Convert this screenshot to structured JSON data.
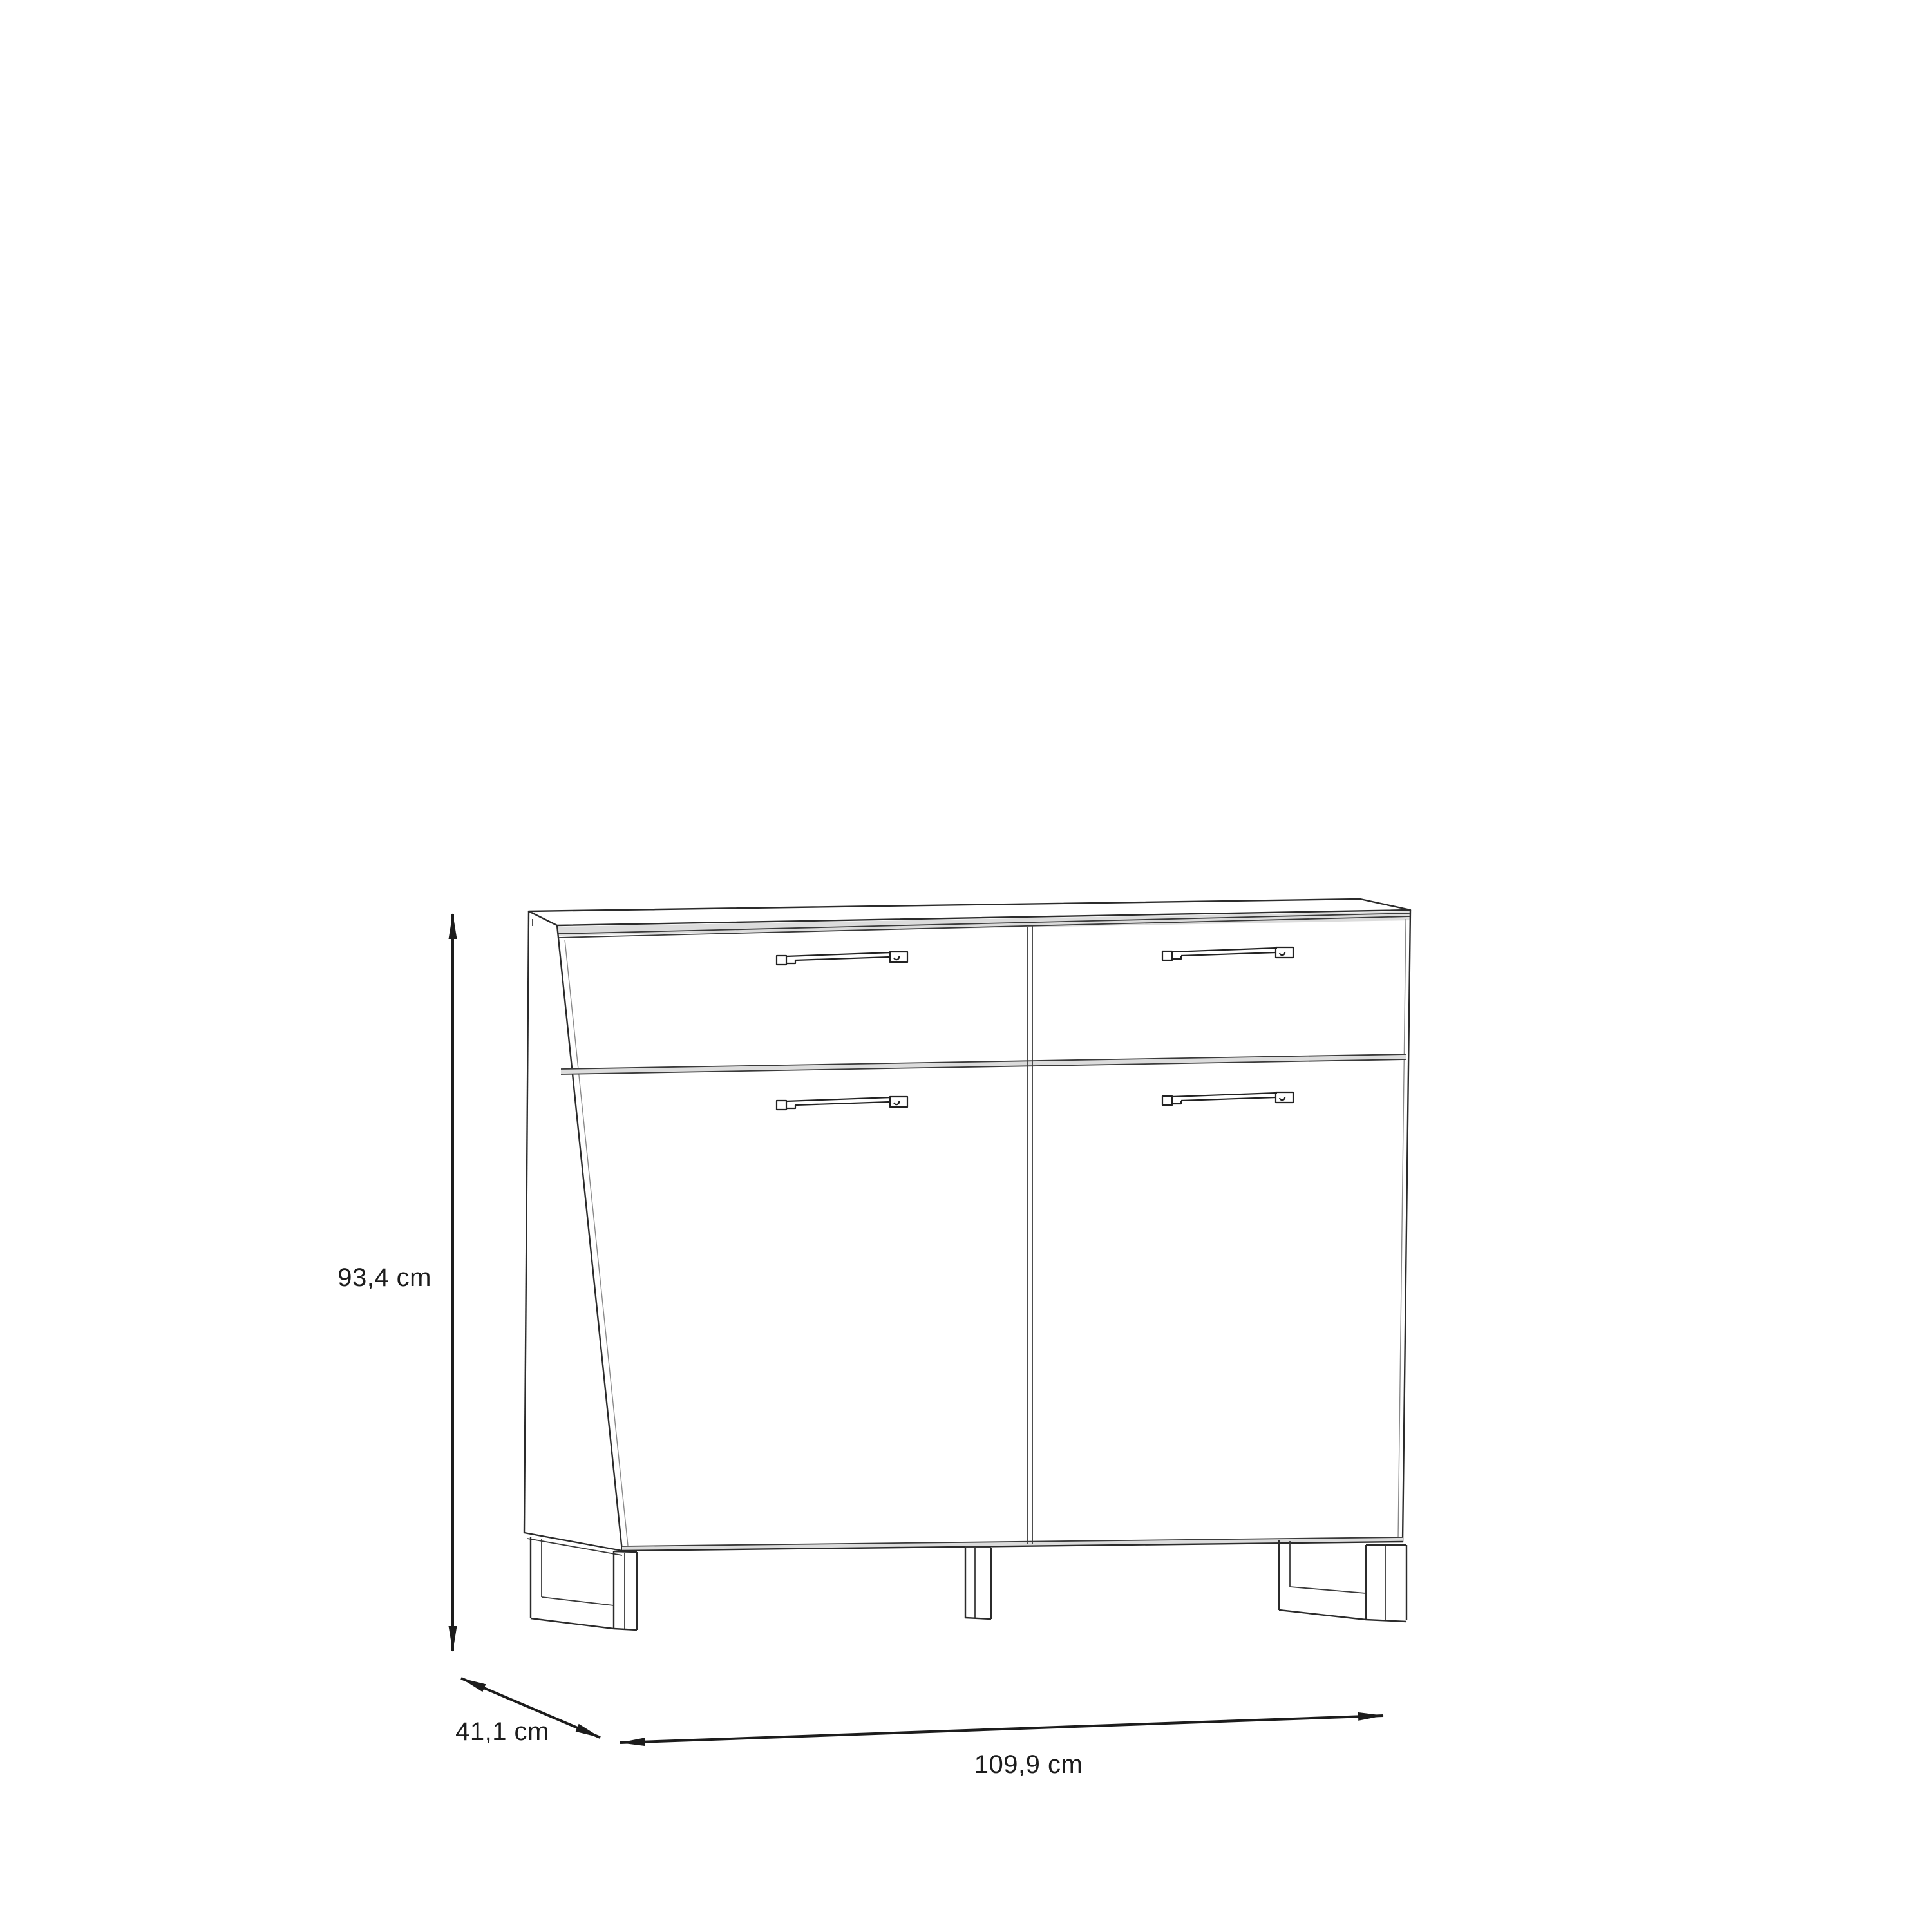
{
  "page": {
    "background": "#ffffff"
  },
  "diagram": {
    "kind": "furniture-dimension-drawing",
    "subject": "sideboard with 2 drawers, 2 doors, bar handles and sled legs",
    "dimensions": {
      "height": {
        "label": "93,4 cm",
        "orientation": "vertical"
      },
      "depth": {
        "label": "41,1 cm",
        "orientation": "diagonal"
      },
      "width": {
        "label": "109,9 cm",
        "orientation": "horizontal"
      }
    },
    "colors": {
      "line": "#2b2b2b",
      "dimension_line": "#1c1c1c",
      "band": "#dcdcdc",
      "background": "#ffffff"
    }
  }
}
